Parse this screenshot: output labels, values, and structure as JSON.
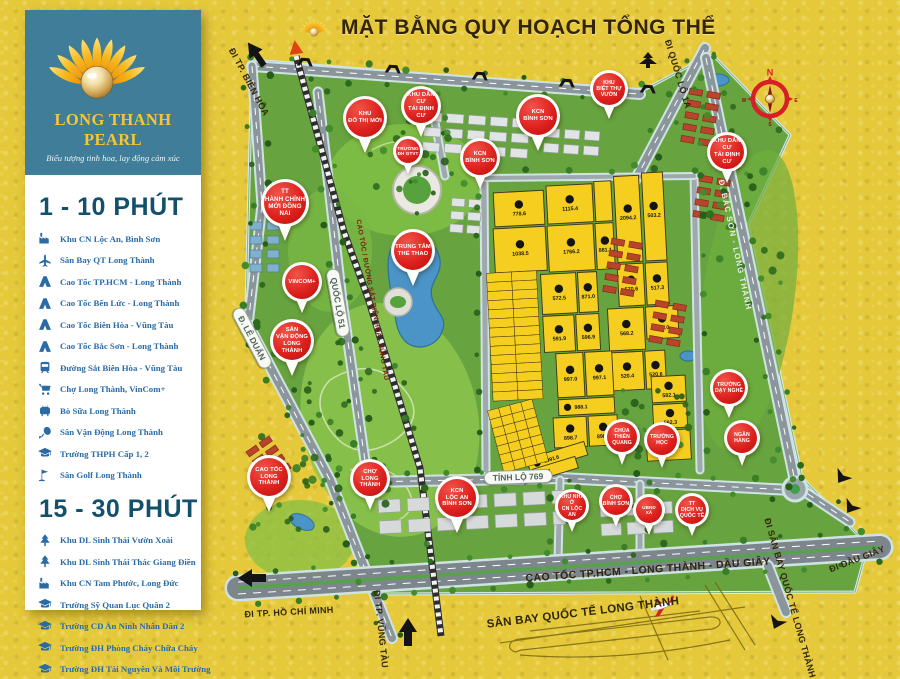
{
  "header": {
    "title": "MẶT BẰNG QUY HOẠCH TỔNG THỂ"
  },
  "sidebar": {
    "brand": {
      "name": "LONG THANH PEARL",
      "tagline": "Biểu tượng tinh hoa, lay động cảm xúc"
    },
    "sections": [
      {
        "heading": "1 - 10 PHÚT",
        "items": [
          {
            "icon": "factory",
            "label": "Khu CN Lộc An, Bình Sơn"
          },
          {
            "icon": "plane",
            "label": "Sân Bay QT Long Thành"
          },
          {
            "icon": "highway",
            "label": "Cao Tốc TP.HCM - Long Thành"
          },
          {
            "icon": "highway",
            "label": "Cao Tốc Bến Lức - Long Thành"
          },
          {
            "icon": "highway",
            "label": "Cao Tốc Biên Hòa - Vũng Tàu"
          },
          {
            "icon": "highway",
            "label": "Cao Tốc Bắc Sơn - Long Thành"
          },
          {
            "icon": "train",
            "label": "Đường Sắt Biên Hòa - Vũng Tàu"
          },
          {
            "icon": "cart",
            "label": "Chợ Long Thành, VinCom+"
          },
          {
            "icon": "cow",
            "label": "Bò Sữa Long Thành"
          },
          {
            "icon": "sports",
            "label": "Sân Vận Động Long Thành"
          },
          {
            "icon": "school",
            "label": "Trường THPH Cấp 1, 2"
          },
          {
            "icon": "golf",
            "label": "Sân Golf Long Thành"
          }
        ]
      },
      {
        "heading": "15 - 30 PHÚT",
        "items": [
          {
            "icon": "park",
            "label": "Khu DL Sinh Thái Vườn Xoài"
          },
          {
            "icon": "park",
            "label": "Khu DL Sinh Thái Thác Giang Điền"
          },
          {
            "icon": "factory",
            "label": "Khu CN Tam Phước, Long Đức"
          },
          {
            "icon": "school",
            "label": "Trường Sỹ Quan Lục Quân 2"
          },
          {
            "icon": "school",
            "label": "Trường CD An Ninh Nhân Dân 2"
          },
          {
            "icon": "school",
            "label": "Trường ĐH Phòng Cháy Chữa Cháy"
          },
          {
            "icon": "school",
            "label": "Trường ĐH Tài Nguyên Và Môi Trường"
          },
          {
            "icon": "hospital",
            "label": "Bệnh Viện Đa Khoa Đồng Nai"
          }
        ]
      }
    ]
  },
  "map": {
    "pins": [
      {
        "lines": [
          "KHU",
          "ĐÔ THỊ MỚI"
        ],
        "x": 365,
        "y": 118,
        "s": 44
      },
      {
        "lines": [
          "KHU DÂN CƯ",
          "TÁI ĐỊNH CƯ"
        ],
        "x": 421,
        "y": 106,
        "s": 40
      },
      {
        "lines": [
          "KCN",
          "BÌNH SƠN"
        ],
        "x": 538,
        "y": 116,
        "s": 44
      },
      {
        "lines": [
          "TRƯỜNG",
          "ĐH GTVT"
        ],
        "x": 408,
        "y": 151,
        "s": 30
      },
      {
        "lines": [
          "KCN",
          "BÌNH SƠN"
        ],
        "x": 480,
        "y": 158,
        "s": 40
      },
      {
        "lines": [
          "TT",
          "HÀNH CHÍNH",
          "MỚI ĐỒNG NAI"
        ],
        "x": 285,
        "y": 203,
        "s": 48
      },
      {
        "lines": [
          "KHU",
          "BIỆT THỰ",
          "VƯỜN"
        ],
        "x": 609,
        "y": 89,
        "s": 38
      },
      {
        "lines": [
          "KHU DÂN CƯ",
          "TÁI ĐỊNH CƯ"
        ],
        "x": 727,
        "y": 152,
        "s": 40
      },
      {
        "lines": [
          "VINCOM+"
        ],
        "x": 302,
        "y": 282,
        "s": 40
      },
      {
        "lines": [
          "TRUNG TÂM",
          "THỂ THAO"
        ],
        "x": 413,
        "y": 251,
        "s": 44
      },
      {
        "lines": [
          "SÂN",
          "VẬN ĐỘNG",
          "LONG THÀNH"
        ],
        "x": 292,
        "y": 341,
        "s": 44
      },
      {
        "lines": [
          "CAO TỐC",
          "LONG THÀNH"
        ],
        "x": 269,
        "y": 477,
        "s": 44
      },
      {
        "lines": [
          "CHỢ",
          "LONG THÀNH"
        ],
        "x": 370,
        "y": 479,
        "s": 40
      },
      {
        "lines": [
          "KCN",
          "LỘC AN",
          "BÌNH SƠN"
        ],
        "x": 457,
        "y": 498,
        "s": 44
      },
      {
        "lines": [
          "KHU NHÀ Ở",
          "CN LỘC AN"
        ],
        "x": 572,
        "y": 506,
        "s": 34
      },
      {
        "lines": [
          "CHỢ",
          "BÌNH SƠN"
        ],
        "x": 616,
        "y": 501,
        "s": 34
      },
      {
        "lines": [
          "CHÙA",
          "THIÊN QUANG"
        ],
        "x": 622,
        "y": 437,
        "s": 36
      },
      {
        "lines": [
          "TRƯỜNG HỌC"
        ],
        "x": 662,
        "y": 440,
        "s": 36
      },
      {
        "lines": [
          "TRƯỜNG",
          "DẠY NGHỀ"
        ],
        "x": 729,
        "y": 388,
        "s": 38
      },
      {
        "lines": [
          "NGÂN HÀNG"
        ],
        "x": 742,
        "y": 438,
        "s": 36
      },
      {
        "lines": [
          "UBND",
          "XÃ"
        ],
        "x": 649,
        "y": 510,
        "s": 32
      },
      {
        "lines": [
          "TT",
          "DỊCH VỤ",
          "QUỐC TẾ"
        ],
        "x": 692,
        "y": 510,
        "s": 34
      }
    ],
    "road_labels": [
      {
        "text": "ĐI TP. BIÊN HÒA",
        "x": 249,
        "y": 82,
        "rot": 62,
        "style": "dark"
      },
      {
        "text": "ĐI QUỐC LỘ 1A",
        "x": 678,
        "y": 74,
        "rot": 73,
        "style": "dark"
      },
      {
        "text": "QUỐC LỘ 51",
        "x": 338,
        "y": 303,
        "rot": 80,
        "style": "pill"
      },
      {
        "text": "CAO TỐC / ĐƯỜNG SẮT BIÊN HÒA - VŨNG TÀU",
        "x": 372,
        "y": 300,
        "rot": 80,
        "style": "rail"
      },
      {
        "text": "Đ. LÊ DUẨN",
        "x": 252,
        "y": 338,
        "rot": 62,
        "style": "pill"
      },
      {
        "text": "Đ. BẮC SƠN - LONG THÀNH",
        "x": 735,
        "y": 245,
        "rot": 78,
        "style": "roadwhite"
      },
      {
        "text": "TỈNH LỘ 769",
        "x": 518,
        "y": 477,
        "rot": -2,
        "style": "pill"
      },
      {
        "text": "CAO TỐC TP.HCM - LONG THÀNH - DẦU GIÂY",
        "x": 648,
        "y": 570,
        "rot": -4,
        "style": "hw"
      },
      {
        "text": "ĐI TP. HỒ CHÍ MINH",
        "x": 289,
        "y": 612,
        "rot": -3,
        "style": "dark"
      },
      {
        "text": "ĐI TP. VŨNG TÀU",
        "x": 381,
        "y": 629,
        "rot": 84,
        "style": "dark"
      },
      {
        "text": "ĐI DẦU GIÂY",
        "x": 857,
        "y": 559,
        "rot": -21,
        "style": "dark"
      },
      {
        "text": "ĐI SÂN BAY QUỐC TẾ LONG THÀNH",
        "x": 790,
        "y": 598,
        "rot": 74,
        "style": "dark"
      },
      {
        "text": "SÂN BAY QUỐC TẾ LONG THÀNH",
        "x": 583,
        "y": 613,
        "rot": -7,
        "style": "dark-large"
      }
    ],
    "compass": {
      "n": "N",
      "e": "E",
      "s": "S",
      "w": "W"
    },
    "plots": {
      "cells": [
        {
          "x": 500,
          "y": 188,
          "w": 50,
          "h": 34,
          "v": "778.6"
        },
        {
          "x": 553,
          "y": 184,
          "w": 46,
          "h": 38,
          "v": "1115.4"
        },
        {
          "x": 601,
          "y": 182,
          "w": 17,
          "h": 40
        },
        {
          "x": 621,
          "y": 178,
          "w": 25,
          "h": 86,
          "v": "2094.2"
        },
        {
          "x": 649,
          "y": 176,
          "w": 21,
          "h": 88,
          "v": "503.2"
        },
        {
          "x": 498,
          "y": 224,
          "w": 52,
          "h": 44,
          "v": "1038.5"
        },
        {
          "x": 552,
          "y": 224,
          "w": 46,
          "h": 46,
          "v": "1766.2"
        },
        {
          "x": 600,
          "y": 224,
          "w": 18,
          "h": 46,
          "v": "881.1"
        },
        {
          "x": 620,
          "y": 266,
          "w": 26,
          "h": 42,
          "v": "570.6"
        },
        {
          "x": 648,
          "y": 266,
          "w": 22,
          "h": 42,
          "v": "517.3"
        },
        {
          "x": 543,
          "y": 272,
          "w": 35,
          "h": 40,
          "v": "572.5"
        },
        {
          "x": 580,
          "y": 272,
          "w": 19,
          "h": 40,
          "v": "871.0"
        },
        {
          "x": 543,
          "y": 314,
          "w": 31,
          "h": 36,
          "v": "591.9"
        },
        {
          "x": 576,
          "y": 314,
          "w": 23,
          "h": 36,
          "v": "596.9"
        },
        {
          "x": 608,
          "y": 310,
          "w": 36,
          "h": 42,
          "v": "568.2"
        },
        {
          "x": 646,
          "y": 310,
          "w": 32,
          "h": 32,
          "v": "504.0"
        },
        {
          "x": 608,
          "y": 354,
          "w": 33,
          "h": 38,
          "v": "520.4"
        },
        {
          "x": 643,
          "y": 354,
          "w": 20,
          "h": 38,
          "v": "520.6"
        },
        {
          "x": 554,
          "y": 352,
          "w": 27,
          "h": 44,
          "v": "997.0"
        },
        {
          "x": 583,
          "y": 352,
          "w": 27,
          "h": 44,
          "v": "997.1"
        },
        {
          "x": 554,
          "y": 398,
          "w": 56,
          "h": 16,
          "v": "988.1"
        },
        {
          "x": 548,
          "y": 416,
          "w": 33,
          "h": 30,
          "v": "898.7"
        },
        {
          "x": 583,
          "y": 416,
          "w": 29,
          "h": 30,
          "v": "898.8"
        },
        {
          "x": 648,
          "y": 380,
          "w": 34,
          "h": 26,
          "v": "582.1"
        },
        {
          "x": 648,
          "y": 408,
          "w": 34,
          "h": 24,
          "v": "562.3"
        },
        {
          "x": 520,
          "y": 448,
          "w": 60,
          "h": 14,
          "v": "1091.6",
          "rot": -14
        },
        {
          "x": 514,
          "y": 462,
          "w": 56,
          "h": 12,
          "v": "523.1",
          "rot": -14
        },
        {
          "x": 640,
          "y": 434,
          "w": 44,
          "h": 30,
          "v": "609.7"
        }
      ],
      "strips": [
        {
          "x": 489,
          "y": 268,
          "w": 50,
          "h": 128,
          "rows": 14,
          "cols": 2
        },
        {
          "x": 489,
          "y": 400,
          "w": 46,
          "h": 64,
          "rows": 7,
          "cols": 4,
          "rot": -12
        }
      ]
    }
  },
  "colors": {
    "gold_bg": "#e5c93b",
    "sidebar_teal": "#3f7d98",
    "brand_gold": "#f7c633",
    "heading_blue": "#12506b",
    "item_blue": "#2a6ba6",
    "pin_red": "#dd1f1c",
    "plot_yellow": "#f5ce1f",
    "map_green": "#67a33f",
    "water_blue": "#4a94c8"
  }
}
